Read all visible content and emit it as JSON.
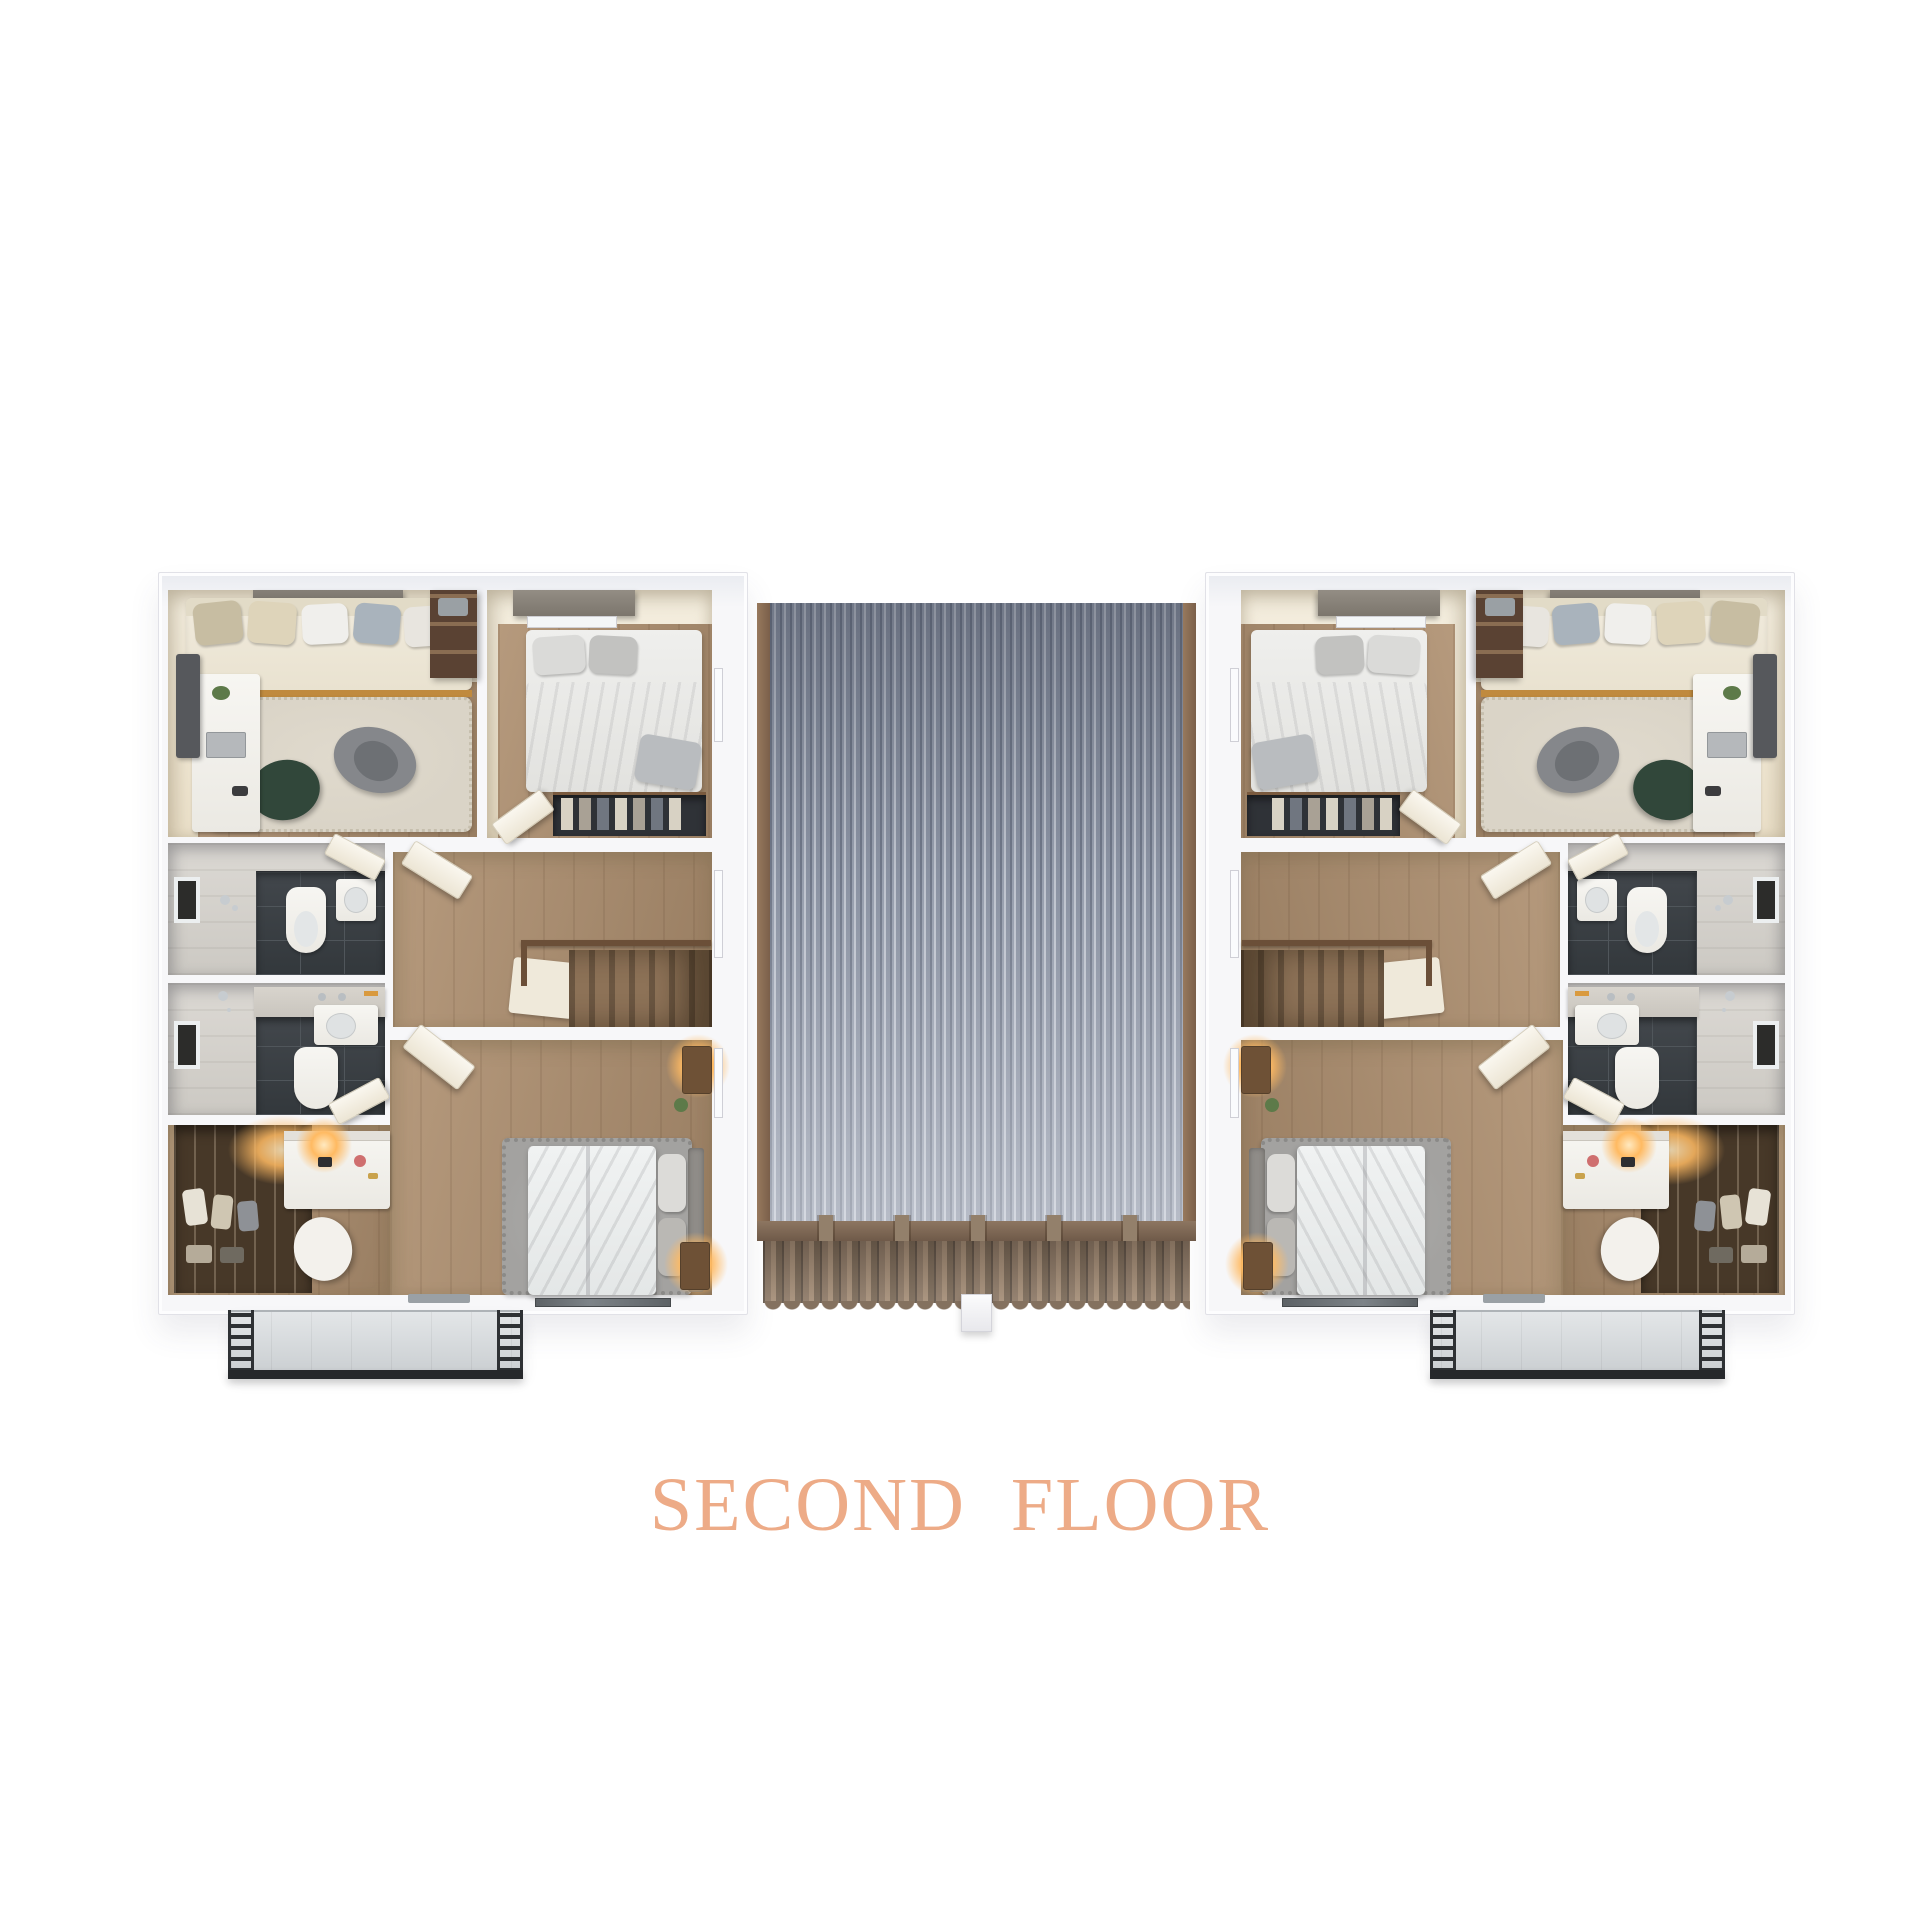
{
  "title": {
    "text": "SECOND FLOOR"
  },
  "palette": {
    "title_color": "#edab87",
    "wall_edge": "#e1e1e7",
    "cream_light": "#f4eedf",
    "cream_dark": "#eadfc8",
    "wood_light": "#b69a7d",
    "wood_dark": "#997e62",
    "carpet_beige": "#dad4c7",
    "rug_gray": "#a3a2a0",
    "marble_light": "#dcd9d4",
    "tile_dark": "#42474c",
    "roof_blue_gray": "#8b93a3",
    "roof_trim_brown": "#97795d",
    "eave_tile_brown": "#8b7867",
    "balcony_floor": "#e3e6e8",
    "railing_dark": "#2e3134",
    "accent_orange_trim": "#c08a3e",
    "lamp_glow": "#ffba62",
    "door_cream": "#faf7ef"
  },
  "scene": {
    "view": "top-down 3d dollhouse floor plan of a duplex",
    "units": [
      "left-unit",
      "right-unit"
    ],
    "rooms_per_unit": [
      "study-with-daybed-and-desk",
      "small-bedroom",
      "bathroom-upper",
      "bathroom-lower",
      "hallway-with-staircase",
      "master-bedroom",
      "walk-in-closet-with-vanity",
      "balcony"
    ],
    "center": "gray corrugated metal roof with brown clay tile eave and small white chimney"
  }
}
